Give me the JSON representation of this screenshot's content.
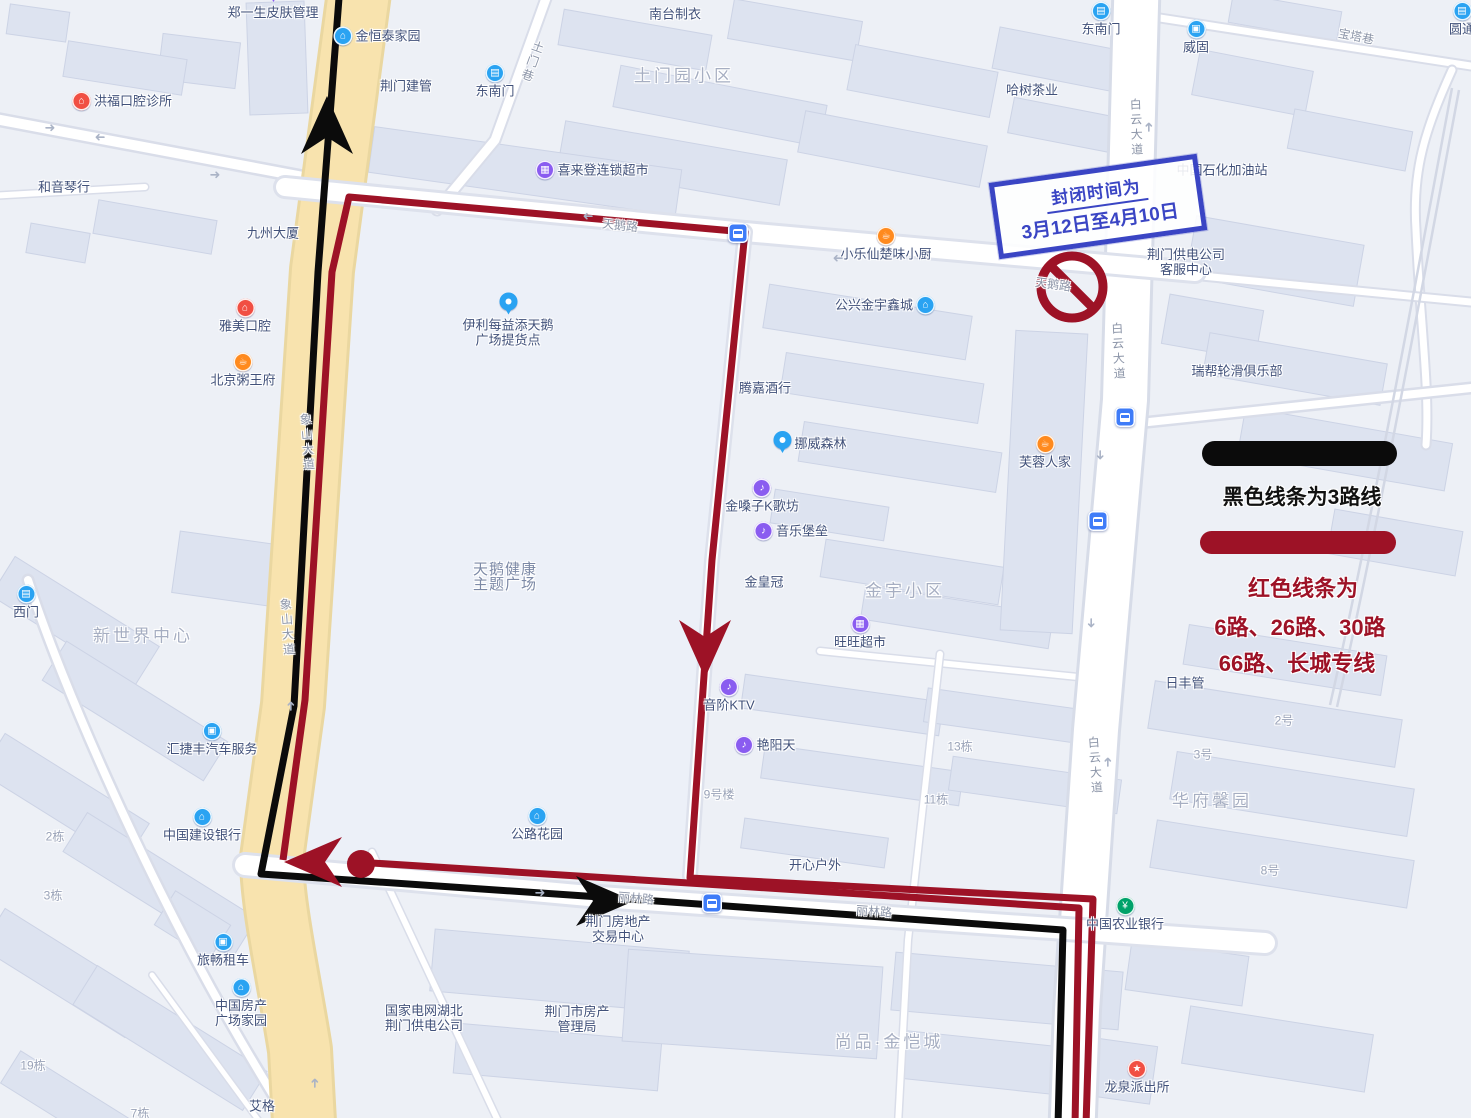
{
  "colors": {
    "route_black": "#0b0b0b",
    "route_red": "#9d1226",
    "notice_blue": "#3a45c4",
    "road_yellow": "#f8e3ae",
    "icon_blue": "#2aa3f2",
    "icon_purple": "#8a5cf0",
    "icon_orange": "#ff8a1e",
    "icon_red": "#f14f43",
    "icon_green": "#00a26a",
    "bus_stop_blue": "#3f7cf8"
  },
  "notice": {
    "line1": "封闭时间为",
    "line2": "3月12日至4月10日"
  },
  "legend": {
    "black_line_label": "黑色线条为3路线",
    "red_line_label_1": "红色线条为",
    "red_line_label_2": "6路、26路、30路",
    "red_line_label_3": "66路、长城专线"
  },
  "map": {
    "pois": [
      {
        "t": "郑一生皮肤管理",
        "x": 273,
        "y": 12,
        "icon": {
          "k": "pin",
          "c": "purple",
          "p": "top"
        }
      },
      {
        "t": "金恒泰家园",
        "x": 377,
        "y": 36,
        "icon": {
          "k": "bank",
          "c": "blue",
          "p": "left"
        }
      },
      {
        "t": "荆门建管",
        "x": 406,
        "y": 86
      },
      {
        "t": "东南门",
        "x": 495,
        "y": 93,
        "icon": {
          "k": "gate",
          "c": "blue",
          "p": "top"
        }
      },
      {
        "t": "洪福口腔诊所",
        "x": 122,
        "y": 101,
        "icon": {
          "k": "home",
          "c": "red",
          "p": "left"
        }
      },
      {
        "t": "和音琴行",
        "x": 64,
        "y": 187
      },
      {
        "t": "九州大厦",
        "x": 273,
        "y": 233
      },
      {
        "t": "雅美口腔",
        "x": 245,
        "y": 328,
        "icon": {
          "k": "home",
          "c": "red",
          "p": "top"
        }
      },
      {
        "t": "北京粥王府",
        "x": 243,
        "y": 382,
        "icon": {
          "k": "food",
          "c": "orange",
          "p": "top"
        }
      },
      {
        "t": "南台制衣",
        "x": 675,
        "y": 14
      },
      {
        "t": "土门园小区",
        "x": 684,
        "y": 76,
        "s": "big"
      },
      {
        "t": "东南门",
        "x": 1101,
        "y": 31,
        "icon": {
          "k": "gate",
          "c": "blue",
          "p": "top"
        }
      },
      {
        "t": "喜来登连锁超市",
        "x": 592,
        "y": 170,
        "icon": {
          "k": "cart",
          "c": "purple",
          "p": "left"
        }
      },
      {
        "t": "威固",
        "x": 1196,
        "y": 49,
        "icon": {
          "k": "car",
          "c": "blue",
          "p": "top"
        }
      },
      {
        "t": "哈树茶业",
        "x": 1032,
        "y": 90
      },
      {
        "t": "中国石化加油站",
        "x": 1222,
        "y": 170
      },
      {
        "t": "小乐仙楚味小厨",
        "x": 886,
        "y": 256,
        "icon": {
          "k": "food",
          "c": "orange",
          "p": "top"
        }
      },
      {
        "t": "公兴金宇鑫城",
        "x": 885,
        "y": 305,
        "icon": {
          "k": "bank",
          "c": "blue",
          "p": "right"
        }
      },
      {
        "t": [
          "荆门供电公司",
          "客服中心"
        ],
        "x": 1186,
        "y": 262
      },
      {
        "t": "瑞帮轮滑俱乐部",
        "x": 1237,
        "y": 371
      },
      {
        "t": "腾嘉酒行",
        "x": 765,
        "y": 388
      },
      {
        "t": "挪威森林",
        "x": 810,
        "y": 443,
        "icon": {
          "k": "pin",
          "c": "blue",
          "p": "left"
        }
      },
      {
        "t": "芙蓉人家",
        "x": 1045,
        "y": 464,
        "icon": {
          "k": "food",
          "c": "orange",
          "p": "top"
        }
      },
      {
        "t": "金嗓子K歌坊",
        "x": 762,
        "y": 508,
        "icon": {
          "k": "mic",
          "c": "purple",
          "p": "top"
        }
      },
      {
        "t": "音乐堡垒",
        "x": 791,
        "y": 531,
        "icon": {
          "k": "mic",
          "c": "purple",
          "p": "left"
        }
      },
      {
        "t": [
          "伊利每益添天鹅",
          "广场提货点"
        ],
        "x": 508,
        "y": 332,
        "icon": {
          "k": "pin",
          "c": "blue",
          "p": "top"
        }
      },
      {
        "t": [
          "天鹅健康",
          "主题广场"
        ],
        "x": 505,
        "y": 577,
        "s": "mid"
      },
      {
        "t": "金皇冠",
        "x": 764,
        "y": 582
      },
      {
        "t": "金宇小区",
        "x": 905,
        "y": 591,
        "s": "big"
      },
      {
        "t": "旺旺超市",
        "x": 860,
        "y": 644,
        "icon": {
          "k": "cart",
          "c": "purple",
          "p": "top"
        }
      },
      {
        "t": "音阶KTV",
        "x": 729,
        "y": 707,
        "icon": {
          "k": "mic",
          "c": "purple",
          "p": "top"
        }
      },
      {
        "t": "艳阳天",
        "x": 765,
        "y": 745,
        "icon": {
          "k": "mic",
          "c": "purple",
          "p": "left"
        }
      },
      {
        "t": "9号楼",
        "x": 719,
        "y": 795,
        "s": "area"
      },
      {
        "t": "13栋",
        "x": 960,
        "y": 747,
        "s": "area"
      },
      {
        "t": "11栋",
        "x": 936,
        "y": 800,
        "s": "area"
      },
      {
        "t": "日丰管",
        "x": 1185,
        "y": 683
      },
      {
        "t": "2号",
        "x": 1284,
        "y": 721,
        "s": "area"
      },
      {
        "t": "3号",
        "x": 1203,
        "y": 755,
        "s": "area"
      },
      {
        "t": "华府馨园",
        "x": 1212,
        "y": 801,
        "s": "big"
      },
      {
        "t": "8号",
        "x": 1270,
        "y": 871,
        "s": "area"
      },
      {
        "t": "西门",
        "x": 26,
        "y": 614,
        "icon": {
          "k": "gate",
          "c": "blue",
          "p": "top"
        }
      },
      {
        "t": "新世界中心",
        "x": 143,
        "y": 636,
        "s": "big"
      },
      {
        "t": "汇捷丰汽车服务",
        "x": 212,
        "y": 751,
        "icon": {
          "k": "car",
          "c": "blue",
          "p": "top"
        }
      },
      {
        "t": "中国建设银行",
        "x": 202,
        "y": 837,
        "icon": {
          "k": "bank",
          "c": "blue",
          "p": "top"
        }
      },
      {
        "t": "2栋",
        "x": 55,
        "y": 837,
        "s": "area"
      },
      {
        "t": "3栋",
        "x": 53,
        "y": 896,
        "s": "area"
      },
      {
        "t": "公路花园",
        "x": 537,
        "y": 836,
        "icon": {
          "k": "bank",
          "c": "blue",
          "p": "top"
        }
      },
      {
        "t": "开心户外",
        "x": 815,
        "y": 865
      },
      {
        "t": "旅畅租车",
        "x": 223,
        "y": 962,
        "icon": {
          "k": "car",
          "c": "blue",
          "p": "top"
        }
      },
      {
        "t": [
          "中国房产",
          "广场家园"
        ],
        "x": 241,
        "y": 1015,
        "icon": {
          "k": "bank",
          "c": "blue",
          "p": "top"
        }
      },
      {
        "t": "19栋",
        "x": 33,
        "y": 1066,
        "s": "area"
      },
      {
        "t": "7栋",
        "x": 140,
        "y": 1114,
        "s": "area"
      },
      {
        "t": "艾格",
        "x": 262,
        "y": 1106
      },
      {
        "t": [
          "国家电网湖北",
          "荆门供电公司"
        ],
        "x": 424,
        "y": 1018
      },
      {
        "t": [
          "荆门市房产",
          "管理局"
        ],
        "x": 577,
        "y": 1019
      },
      {
        "t": [
          "荆门房地产",
          "交易中心"
        ],
        "x": 618,
        "y": 929
      },
      {
        "t": "尚品·金恺城",
        "x": 889,
        "y": 1042,
        "s": "big"
      },
      {
        "t": "中国农业银行",
        "x": 1125,
        "y": 926,
        "icon": {
          "k": "agri",
          "c": "green",
          "p": "top"
        }
      },
      {
        "t": "龙泉派出所",
        "x": 1137,
        "y": 1089,
        "icon": {
          "k": "police",
          "c": "red",
          "p": "top"
        }
      },
      {
        "t": "圆通",
        "x": 1462,
        "y": 31,
        "icon": {
          "k": "express",
          "c": "blue",
          "p": "top"
        }
      },
      {
        "t": "象山大道",
        "x": 307,
        "y": 443,
        "s": "road",
        "vert": true,
        "rot": -4
      },
      {
        "t": "象山大道",
        "x": 287,
        "y": 628,
        "s": "road",
        "vert": true,
        "rot": -4
      },
      {
        "t": "白云大道",
        "x": 1136,
        "y": 128,
        "s": "road",
        "vert": true,
        "rot": -2
      },
      {
        "t": "白云大道",
        "x": 1118,
        "y": 352,
        "s": "road",
        "vert": true,
        "rot": -3
      },
      {
        "t": "白云大道",
        "x": 1095,
        "y": 766,
        "s": "road",
        "vert": true,
        "rot": -4
      },
      {
        "t": "土门巷",
        "x": 532,
        "y": 62,
        "s": "road",
        "vert": true,
        "rot": 20
      },
      {
        "t": "宝塔巷",
        "x": 1356,
        "y": 37,
        "s": "road",
        "rot": 11
      },
      {
        "t": "天鹅路",
        "x": 620,
        "y": 226,
        "s": "road",
        "rot": 6
      },
      {
        "t": "天鹅路",
        "x": 1053,
        "y": 285,
        "s": "road",
        "rot": 8
      },
      {
        "t": "丽林路",
        "x": 636,
        "y": 899,
        "s": "road",
        "rot": 5
      },
      {
        "t": "丽林路",
        "x": 874,
        "y": 912,
        "s": "road",
        "rot": 4
      }
    ],
    "bus_stops": [
      {
        "x": 738,
        "y": 233
      },
      {
        "x": 1125,
        "y": 417
      },
      {
        "x": 1098,
        "y": 521
      },
      {
        "x": 712,
        "y": 903
      }
    ],
    "road_arrows": [
      {
        "x": 50,
        "y": 128,
        "d": "r"
      },
      {
        "x": 100,
        "y": 137,
        "d": "l"
      },
      {
        "x": 215,
        "y": 175,
        "d": "r"
      },
      {
        "x": 588,
        "y": 216,
        "d": "l"
      },
      {
        "x": 838,
        "y": 258,
        "d": "l"
      },
      {
        "x": 1149,
        "y": 127,
        "d": "u"
      },
      {
        "x": 1100,
        "y": 455,
        "d": "d"
      },
      {
        "x": 1091,
        "y": 623,
        "d": "d"
      },
      {
        "x": 1108,
        "y": 762,
        "d": "u"
      },
      {
        "x": 315,
        "y": 1083,
        "d": "u"
      },
      {
        "x": 540,
        "y": 893,
        "d": "r"
      },
      {
        "x": 291,
        "y": 706,
        "d": "u"
      }
    ],
    "icon_glyphs": {
      "bank": "⌂",
      "gate": "▤",
      "home": "⌂",
      "food": "☕",
      "cart": "▦",
      "car": "▣",
      "mic": "♪",
      "police": "★",
      "agri": "¥",
      "express": "▤"
    }
  }
}
